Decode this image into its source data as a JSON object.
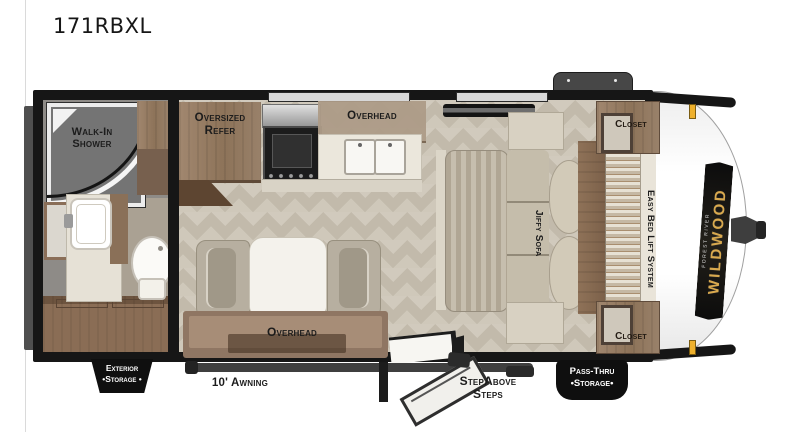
{
  "title": "171RBXL",
  "brand": {
    "name": "WILDWOOD",
    "tagline": "FOREST RIVER"
  },
  "labels": {
    "shower_line1": "Walk-In",
    "shower_line2": "Shower",
    "refer_line1": "Oversized",
    "refer_line2": "Refer",
    "overhead_kitchen": "Overhead",
    "overhead_dinette": "Overhead",
    "jiffy_sofa": "Jiffy Sofa",
    "easy_bed": "Easy Bed Lift System",
    "closet_front_top": "Closet",
    "closet_front_bottom": "Closet",
    "exterior_storage_line1": "Exterior",
    "exterior_storage_line2": "•Storage •",
    "awning": "10' Awning",
    "steps_line1": "StepAbove",
    "steps_line2": "Steps",
    "passthru_line1": "Pass-Thru",
    "passthru_line2": "•Storage•"
  },
  "colors": {
    "wall": "#161616",
    "floor_light": "#d1cabd",
    "floor_dark": "#c2baab",
    "wood_cabinet": "#997e66",
    "wood_dark": "#6e5744",
    "counter": "#ebe7dc",
    "bath_floor": "#8e8b87",
    "label_text": "#1c1c1c",
    "tab_bg": "#0f0f0f",
    "tab_text": "#ffffff",
    "marker_amber": "#eeb02c",
    "brand_gold": "#d9a94e"
  }
}
